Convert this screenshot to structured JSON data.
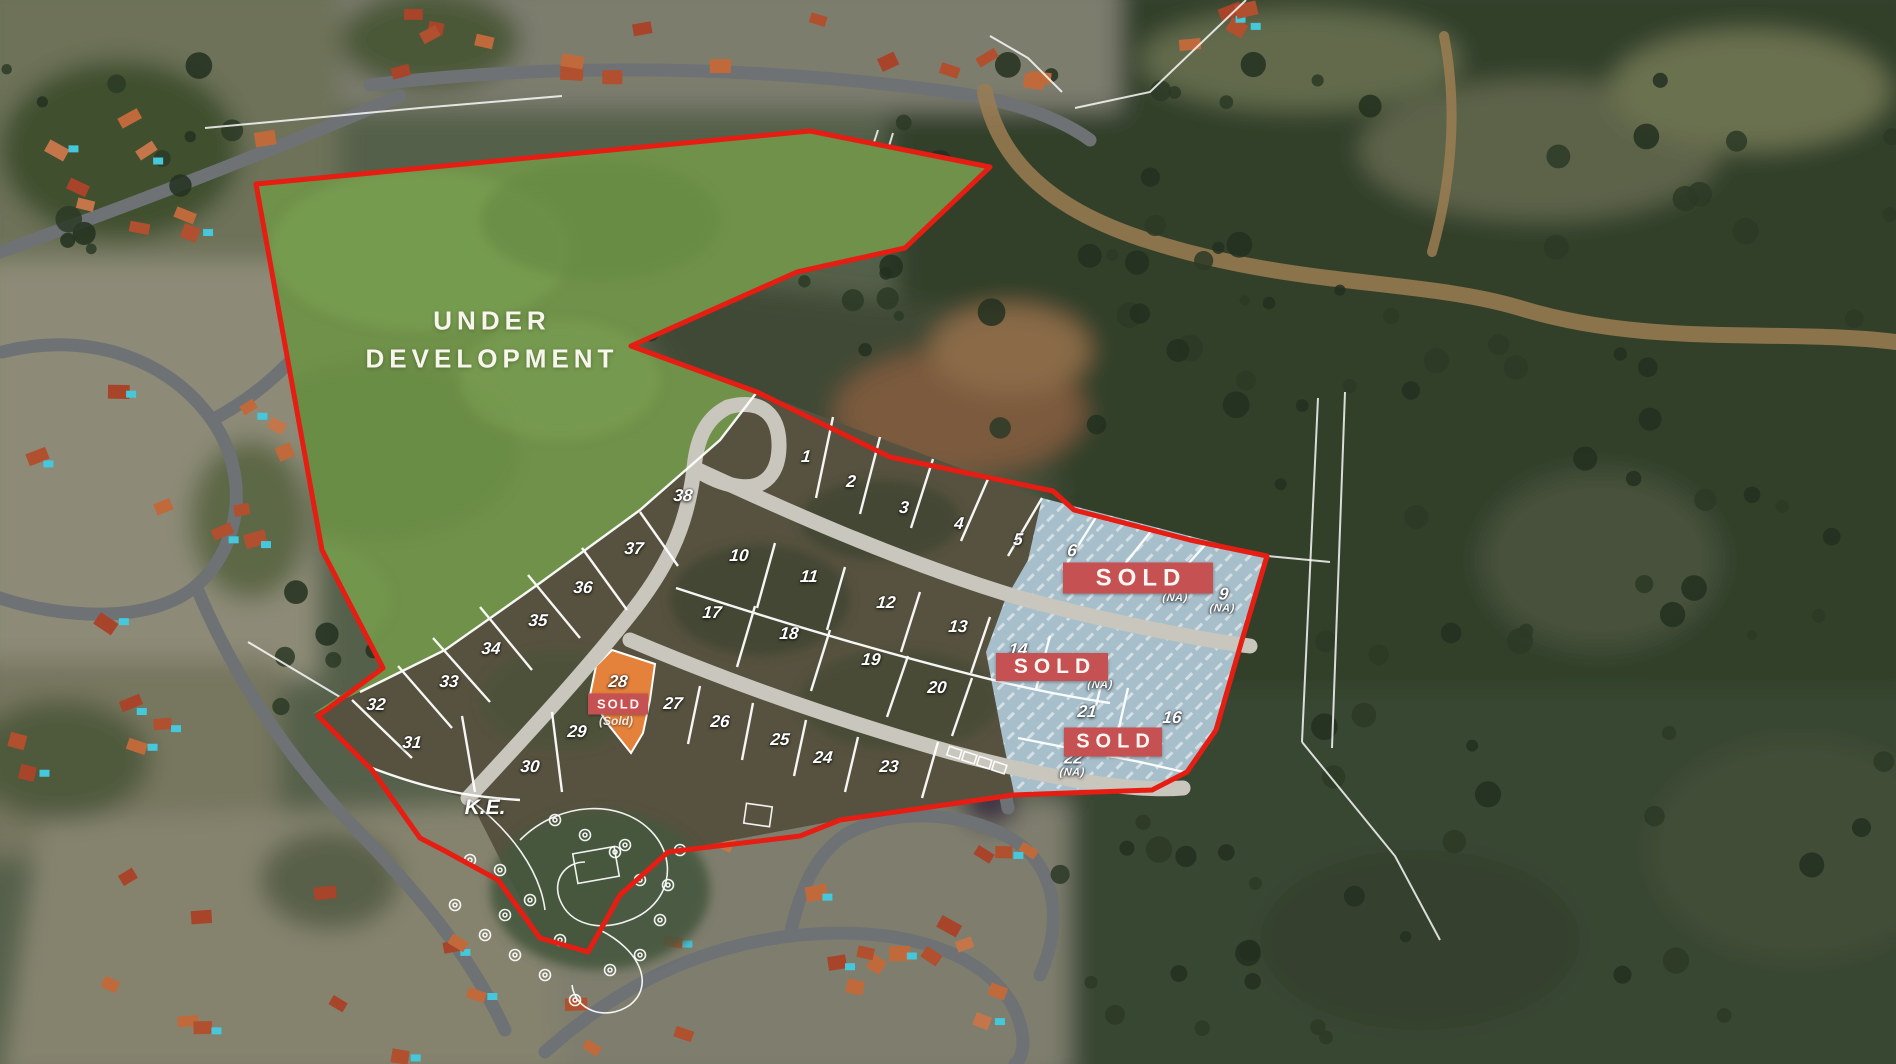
{
  "map": {
    "development_area_label": "UNDER DEVELOPMENT",
    "development_label_pos": {
      "x": 492,
      "y": 340
    },
    "ke_label": "K.E.",
    "ke_label_pos": {
      "x": 485,
      "y": 808
    },
    "sold_label": "SOLD",
    "reserved_plot_sub_label": "(Sold)",
    "colors": {
      "boundary_red": "#e51d13",
      "banner_red": "#c65152",
      "sold_area_blue": "#a7bfcb",
      "reserved_orange": "#e4823b",
      "development_green": "#6f9149"
    },
    "plots": [
      {
        "n": "1",
        "x": 806,
        "y": 457
      },
      {
        "n": "2",
        "x": 851,
        "y": 482
      },
      {
        "n": "3",
        "x": 904,
        "y": 508
      },
      {
        "n": "4",
        "x": 959,
        "y": 524
      },
      {
        "n": "5",
        "x": 1018,
        "y": 540
      },
      {
        "n": "6",
        "x": 1072,
        "y": 551
      },
      {
        "n": "",
        "sub": "(NA)",
        "x": 1175,
        "y": 599
      },
      {
        "n": "9",
        "sub": "(NA)",
        "x": 1223,
        "y": 600
      },
      {
        "n": "10",
        "x": 739,
        "y": 556
      },
      {
        "n": "11",
        "x": 809,
        "y": 577
      },
      {
        "n": "12",
        "x": 886,
        "y": 603
      },
      {
        "n": "13",
        "x": 958,
        "y": 627
      },
      {
        "n": "14",
        "x": 1018,
        "y": 650
      },
      {
        "n": "",
        "sub": "(NA)",
        "x": 1100,
        "y": 686
      },
      {
        "n": "17",
        "x": 712,
        "y": 613
      },
      {
        "n": "18",
        "x": 789,
        "y": 634
      },
      {
        "n": "19",
        "x": 871,
        "y": 660
      },
      {
        "n": "20",
        "x": 937,
        "y": 688
      },
      {
        "n": "21",
        "x": 1087,
        "y": 712
      },
      {
        "n": "16",
        "x": 1172,
        "y": 718
      },
      {
        "n": "22",
        "sub": "(NA)",
        "x": 1073,
        "y": 764
      },
      {
        "n": "23",
        "x": 889,
        "y": 767
      },
      {
        "n": "24",
        "x": 823,
        "y": 758
      },
      {
        "n": "25",
        "x": 780,
        "y": 740
      },
      {
        "n": "26",
        "x": 720,
        "y": 722
      },
      {
        "n": "27",
        "x": 673,
        "y": 704
      },
      {
        "n": "28",
        "x": 618,
        "y": 682
      },
      {
        "n": "29",
        "x": 577,
        "y": 732
      },
      {
        "n": "30",
        "x": 530,
        "y": 767
      },
      {
        "n": "31",
        "x": 412,
        "y": 743
      },
      {
        "n": "32",
        "x": 376,
        "y": 705
      },
      {
        "n": "33",
        "x": 449,
        "y": 682
      },
      {
        "n": "34",
        "x": 491,
        "y": 649
      },
      {
        "n": "35",
        "x": 538,
        "y": 621
      },
      {
        "n": "36",
        "x": 583,
        "y": 588
      },
      {
        "n": "37",
        "x": 634,
        "y": 549
      },
      {
        "n": "38",
        "x": 683,
        "y": 496
      }
    ],
    "sold_banners": [
      {
        "x": 1138,
        "y": 578,
        "w": 150,
        "h": 31,
        "fs": 24,
        "size": "large"
      },
      {
        "x": 1052,
        "y": 667,
        "w": 112,
        "h": 28,
        "fs": 21,
        "size": "large"
      },
      {
        "x": 1113,
        "y": 742,
        "w": 98,
        "h": 29,
        "fs": 20,
        "size": "large"
      },
      {
        "x": 618,
        "y": 704,
        "w": 60,
        "h": 21,
        "fs": 13,
        "size": "small"
      }
    ],
    "reserved_sub_pos": {
      "x": 616,
      "y": 721
    }
  }
}
